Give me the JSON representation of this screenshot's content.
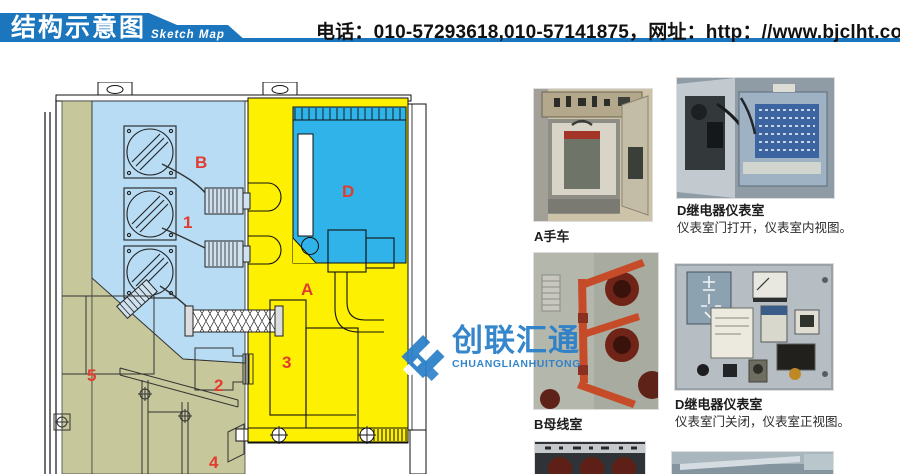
{
  "header": {
    "title_cn": "结构示意图",
    "title_en": "Sketch Map",
    "contact": "电话：010-57293618,010-57141875，网址：http：//www.bjclht.com",
    "banner_color": "#1b76bd"
  },
  "watermark": {
    "name_cn": "创联汇通",
    "name_en": "CHUANGLIANHUITONG",
    "color": "#2c80c9"
  },
  "diagram": {
    "colors": {
      "light_blue_room": "#b7dcf3",
      "yellow_room": "#fdf000",
      "cyan_room": "#2fb3e8",
      "olive_room": "#c6c79b",
      "label_red": "#e23b30"
    },
    "labels": [
      {
        "text": "B"
      },
      {
        "text": "1"
      },
      {
        "text": "D"
      },
      {
        "text": "A"
      },
      {
        "text": "3"
      },
      {
        "text": "2"
      },
      {
        "text": "5"
      },
      {
        "text": "4"
      }
    ]
  },
  "photos": [
    {
      "title": "A手车",
      "desc": ""
    },
    {
      "title": "D继电器仪表室",
      "desc": "仪表室门打开，仪表室内视图。"
    },
    {
      "title": "B母线室",
      "desc": ""
    },
    {
      "title": "D继电器仪表室",
      "desc": "仪表室门关闭，仪表室正视图。"
    }
  ]
}
